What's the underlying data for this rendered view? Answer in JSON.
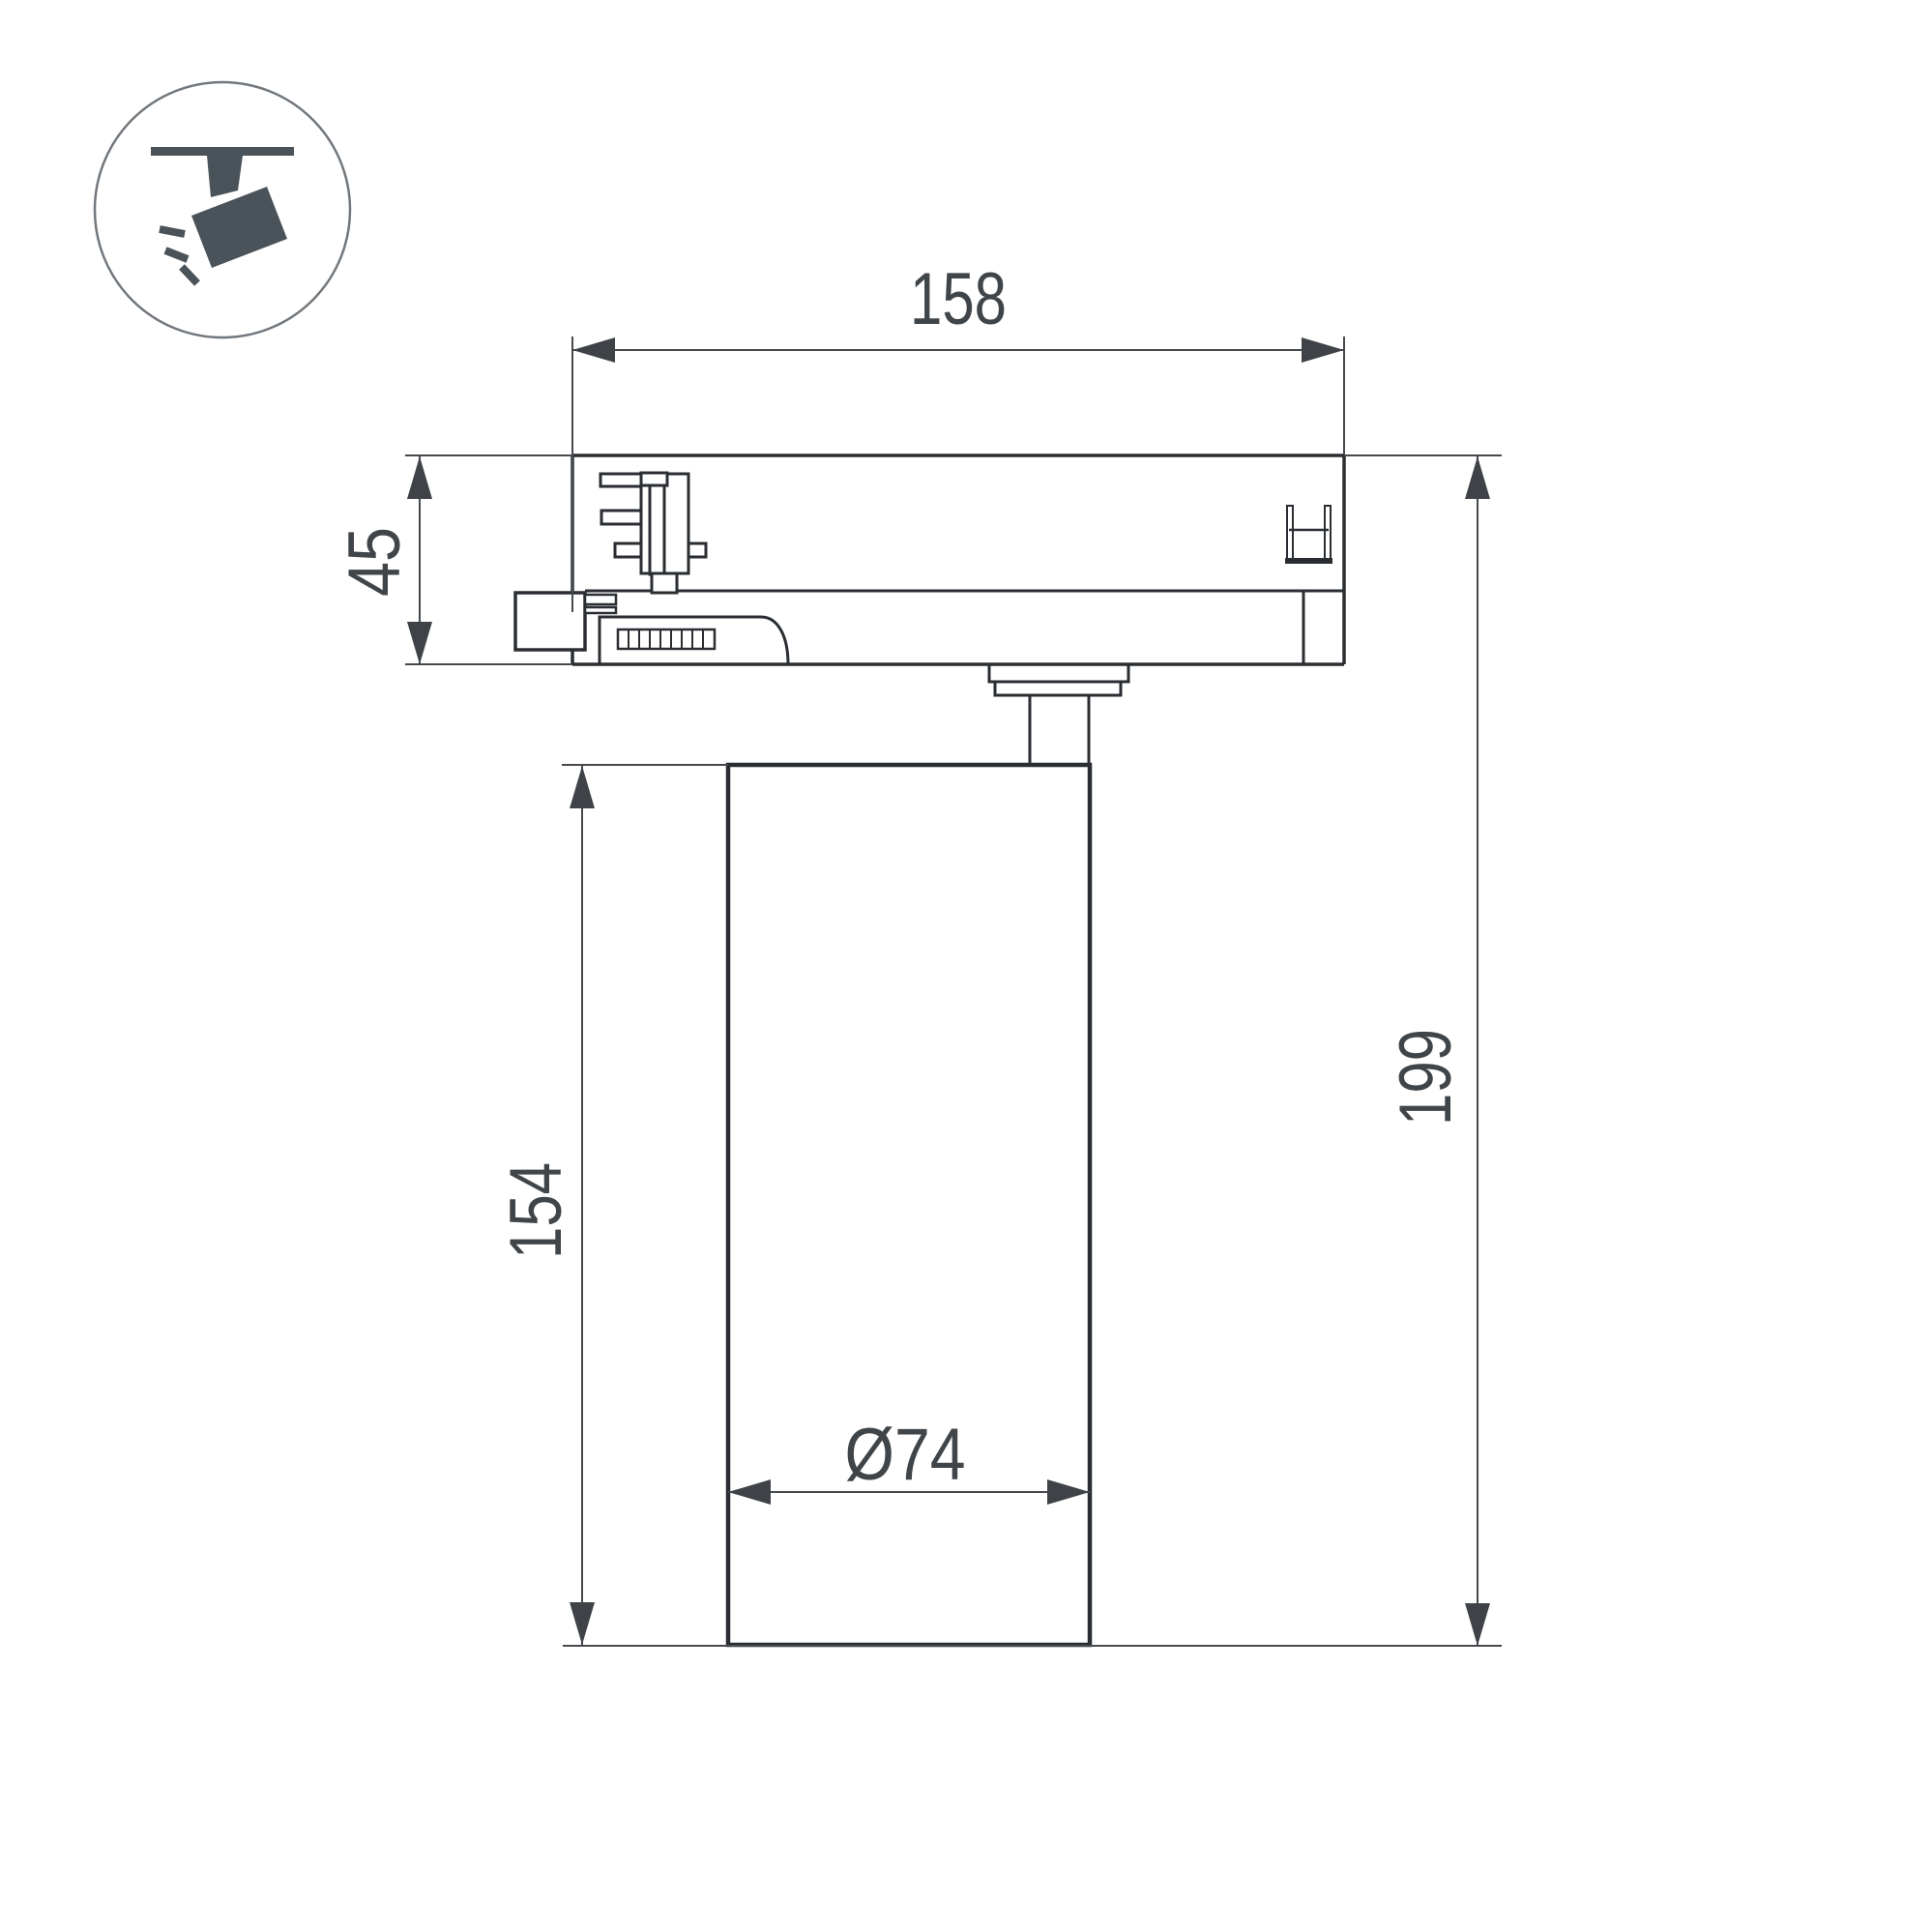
{
  "drawing": {
    "kind": "track-spotlight dimensional drawing",
    "labels": {
      "adapter_width": "158",
      "adapter_height": "45",
      "body_height": "154",
      "total_height": "199",
      "body_diameter": "Ø74"
    },
    "values_mm": {
      "adapter_width": 158,
      "adapter_height": 45,
      "body_height": 154,
      "total_height": 199,
      "body_diameter": 74
    },
    "colors": {
      "part_outline": "#2a2e32",
      "dimension_lines": "#46494d",
      "dimension_text": "#404549",
      "icon_glyph": "#4b535a",
      "icon_circle": "#71777c",
      "background": "#ffffff"
    }
  }
}
